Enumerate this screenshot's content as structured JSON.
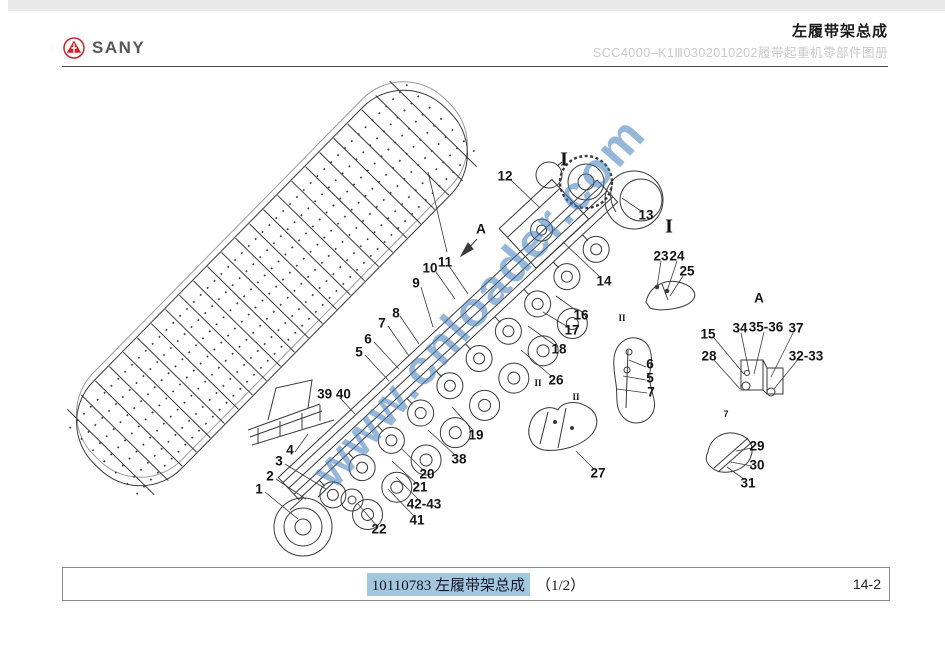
{
  "header": {
    "brand": "SANY",
    "title": "左履带架总成",
    "subtitle": "SCC4000–K1Ⅲ0302010202履带起重机零部件图册"
  },
  "watermark": {
    "text": "www.cnloader.com",
    "color": "rgba(64,122,188,0.55)"
  },
  "footer": {
    "part_number": "10110783",
    "part_name": "左履带架总成",
    "page_indicator": "（1/2）",
    "page_number": "14-2",
    "highlight_color": "#a3c8de"
  },
  "diagram": {
    "labels": [
      {
        "t": "1",
        "x": 259,
        "y": 489
      },
      {
        "t": "2",
        "x": 270,
        "y": 476
      },
      {
        "t": "3",
        "x": 279,
        "y": 461
      },
      {
        "t": "4",
        "x": 290,
        "y": 450
      },
      {
        "t": "5",
        "x": 359,
        "y": 352
      },
      {
        "t": "6",
        "x": 368,
        "y": 339
      },
      {
        "t": "7",
        "x": 382,
        "y": 323
      },
      {
        "t": "8",
        "x": 396,
        "y": 313
      },
      {
        "t": "9",
        "x": 416,
        "y": 283
      },
      {
        "t": "10",
        "x": 430,
        "y": 268
      },
      {
        "t": "11",
        "x": 445,
        "y": 262
      },
      {
        "t": "12",
        "x": 505,
        "y": 176
      },
      {
        "t": "13",
        "x": 646,
        "y": 215
      },
      {
        "t": "14",
        "x": 604,
        "y": 281
      },
      {
        "t": "15",
        "x": 708,
        "y": 334
      },
      {
        "t": "16",
        "x": 581,
        "y": 315
      },
      {
        "t": "17",
        "x": 572,
        "y": 330
      },
      {
        "t": "18",
        "x": 559,
        "y": 349
      },
      {
        "t": "19",
        "x": 476,
        "y": 435
      },
      {
        "t": "20",
        "x": 427,
        "y": 474
      },
      {
        "t": "21",
        "x": 420,
        "y": 487
      },
      {
        "t": "22",
        "x": 379,
        "y": 529
      },
      {
        "t": "23",
        "x": 661,
        "y": 256
      },
      {
        "t": "24",
        "x": 677,
        "y": 256
      },
      {
        "t": "25",
        "x": 687,
        "y": 271
      },
      {
        "t": "26",
        "x": 556,
        "y": 380
      },
      {
        "t": "27",
        "x": 598,
        "y": 473
      },
      {
        "t": "28",
        "x": 709,
        "y": 356
      },
      {
        "t": "29",
        "x": 757,
        "y": 446
      },
      {
        "t": "30",
        "x": 757,
        "y": 465
      },
      {
        "t": "31",
        "x": 748,
        "y": 483
      },
      {
        "t": "32-33",
        "x": 806,
        "y": 356
      },
      {
        "t": "34",
        "x": 740,
        "y": 328
      },
      {
        "t": "35-36",
        "x": 766,
        "y": 327
      },
      {
        "t": "37",
        "x": 796,
        "y": 328
      },
      {
        "t": "38",
        "x": 459,
        "y": 459
      },
      {
        "t": "39 40",
        "x": 334,
        "y": 394
      },
      {
        "t": "41",
        "x": 417,
        "y": 520
      },
      {
        "t": "42-43",
        "x": 424,
        "y": 504
      },
      {
        "t": "6",
        "x": 650,
        "y": 364
      },
      {
        "t": "5",
        "x": 650,
        "y": 378
      },
      {
        "t": "7",
        "x": 651,
        "y": 392
      },
      {
        "t": "A",
        "x": 481,
        "y": 229
      },
      {
        "t": "A",
        "x": 759,
        "y": 298
      },
      {
        "t": "I",
        "x": 564,
        "y": 160,
        "fs": 20,
        "serif": true
      },
      {
        "t": "I",
        "x": 669,
        "y": 227,
        "fs": 20,
        "serif": true
      },
      {
        "t": "II",
        "x": 622,
        "y": 318,
        "fs": 9,
        "serif": true
      },
      {
        "t": "II",
        "x": 538,
        "y": 383,
        "fs": 9,
        "serif": true
      },
      {
        "t": "II",
        "x": 576,
        "y": 397,
        "fs": 9,
        "serif": true
      },
      {
        "t": "7",
        "x": 726,
        "y": 414,
        "fs": 9
      }
    ]
  }
}
